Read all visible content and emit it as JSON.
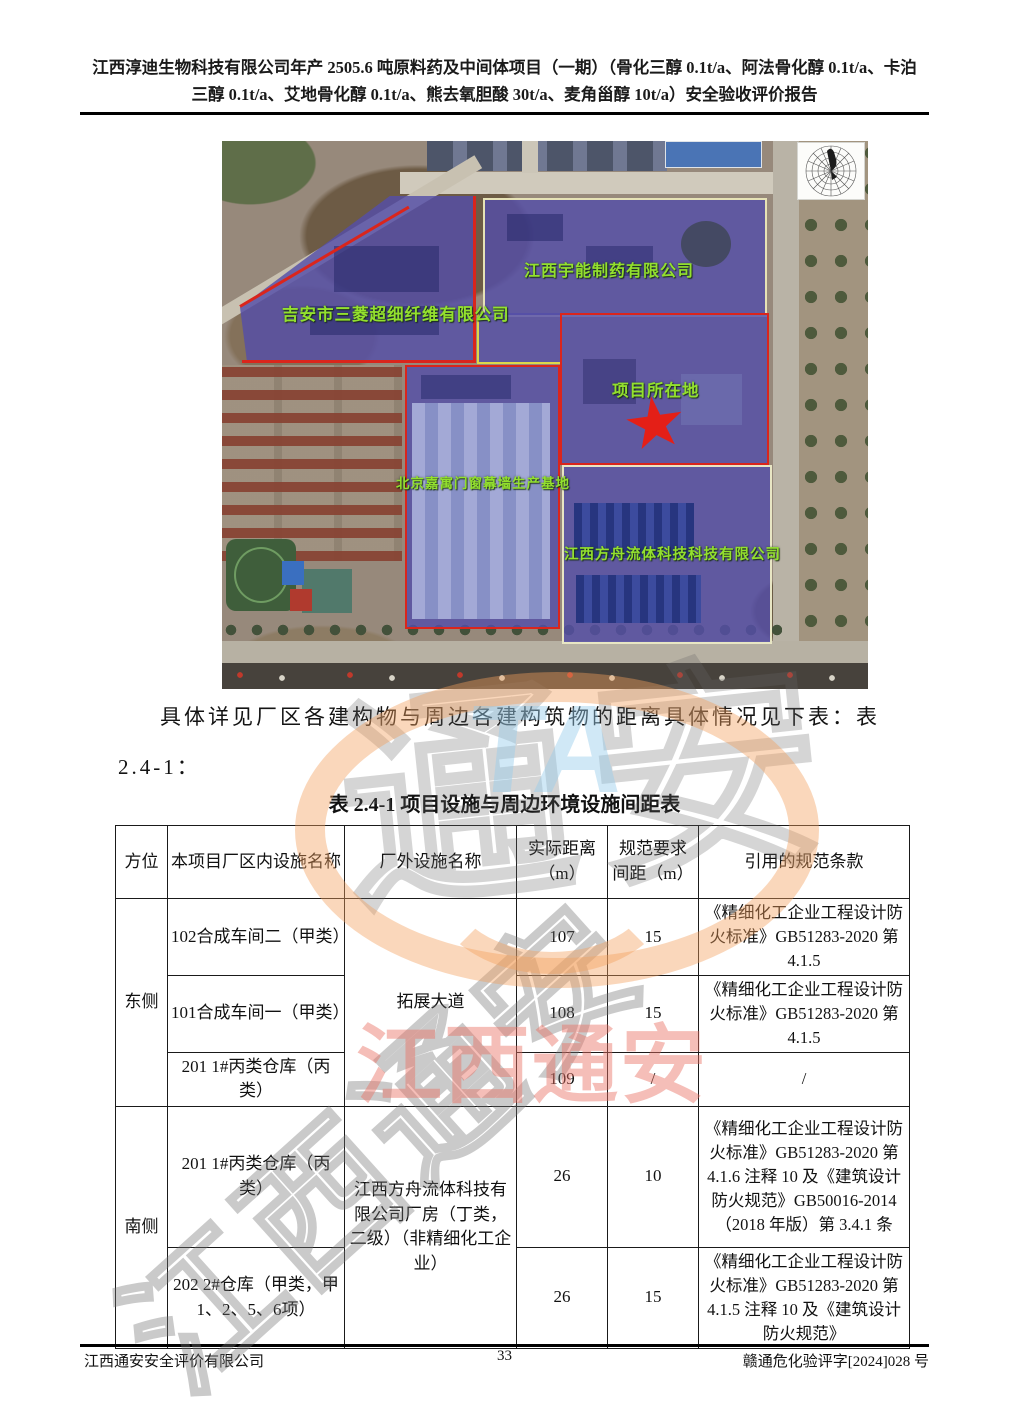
{
  "header": {
    "line1": "江西淳迪生物科技有限公司年产 2505.6 吨原料药及中间体项目（一期）（骨化三醇 0.1t/a、阿法骨化醇 0.1t/a、卡泊",
    "line2": "三醇 0.1t/a、艾地骨化醇 0.1t/a、熊去氧胆酸 30t/a、麦角甾醇 10t/a）安全验收评价报告"
  },
  "map": {
    "labels": {
      "yuneng": "江西宇能制药有限公司",
      "sanling": "吉安市三菱超细纤维有限公司",
      "project": "项目所在地",
      "jiayu": "北京嘉寓门窗幕墙生产基地",
      "fangzhou": "江西方舟流体科技科技有限公司"
    }
  },
  "paragraph": "具体详见厂区各建构物与周边各建构筑物的距离具体情况见下表：表 2.4-1：",
  "table": {
    "title": "表 2.4-1 项目设施与周边环境设施间距表",
    "headers": [
      "方位",
      "本项目厂区内设施名称",
      "厂外设施名称",
      "实际距离（m）",
      "规范要求间距（m）",
      "引用的规范条款"
    ],
    "rows": [
      {
        "direction": "东侧",
        "facility": "102合成车间二（甲类）",
        "outside": "拓展大道",
        "actual": "107",
        "required": "15",
        "code": "《精细化工企业工程设计防火标准》GB51283-2020 第 4.1.5"
      },
      {
        "facility": "101合成车间一（甲类）",
        "actual": "108",
        "required": "15",
        "code": "《精细化工企业工程设计防火标准》GB51283-2020 第 4.1.5"
      },
      {
        "facility": "201 1#丙类仓库（丙类）",
        "actual": "109",
        "required": "/",
        "code": "/"
      },
      {
        "direction": "南侧",
        "facility": "201 1#丙类仓库（丙类）",
        "outside": "江西方舟流体科技有限公司厂房（丁类，二级）（非精细化工企业）",
        "actual": "26",
        "required": "10",
        "code": "《精细化工企业工程设计防火标准》GB51283-2020 第 4.1.6 注释 10 及《建筑设计防火规范》GB50016-2014（2018 年版）第 3.4.1 条"
      },
      {
        "facility": "202 2#仓库（甲类，甲1、2、5、6项）",
        "actual": "26",
        "required": "15",
        "code": "《精细化工企业工程设计防火标准》GB51283-2020 第 4.1.5 注释 10 及《建筑设计防火规范》"
      }
    ]
  },
  "footer": {
    "company": "江西通安安全评价有限公司",
    "page_number": "33",
    "doc_number": "赣通危化验评字[2024]028 号"
  },
  "watermark": {
    "cn": "江西通安",
    "cn_part": "通安",
    "latin": "TA"
  },
  "colors": {
    "zone_purple": "#544ea8",
    "boundary_red": "#da251c",
    "boundary_yellow": "#dcd84a",
    "label_green": "#93e02e",
    "star_red": "#e41f17",
    "watermark_pink": "#e96e62",
    "watermark_orange": "#f3a05e",
    "watermark_blue": "#96cdeb"
  }
}
